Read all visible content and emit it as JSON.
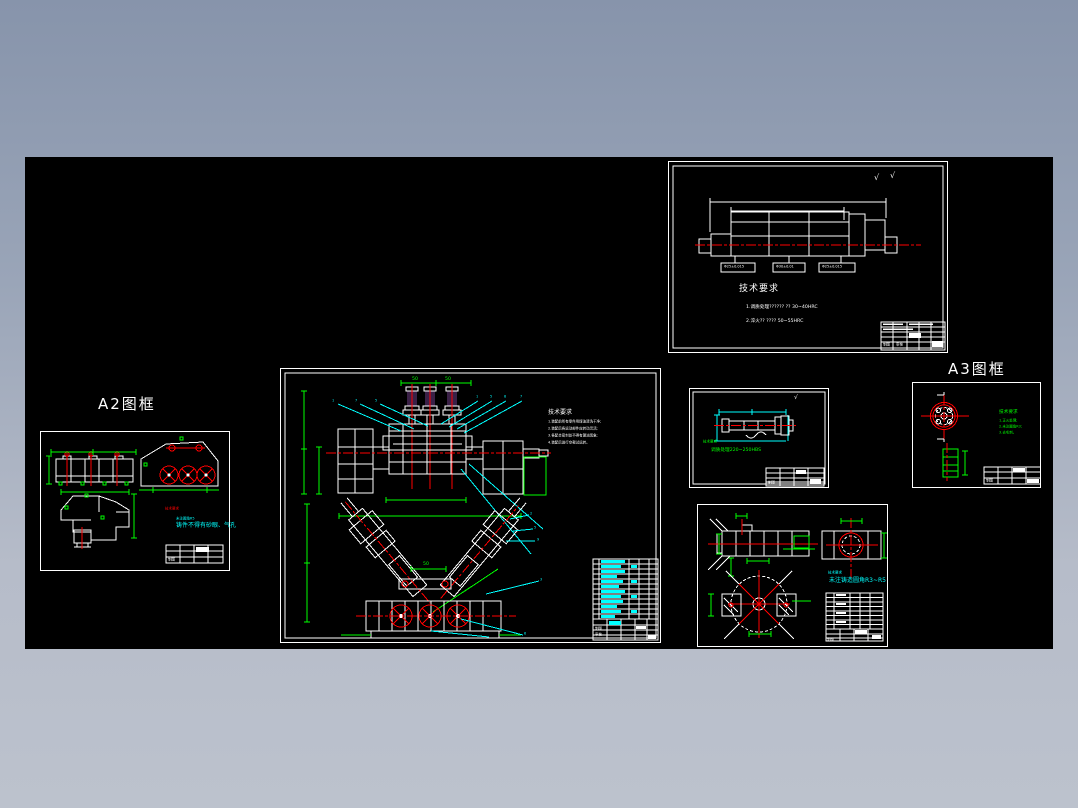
{
  "labels": {
    "a2_frame": "A2图框",
    "a3_frame": "A3图框"
  },
  "palette": {
    "line": "#ffffff",
    "centerline": "#ff0000",
    "dimension": "#00ff00",
    "leader": "#00ffff",
    "cylinder_fill": "#3a2147",
    "workspace": "#000000"
  },
  "shaft_frame": {
    "tech_title": "技术要求",
    "note1": "1.调质处理?????? ?? 30~40HRC",
    "note2": "2.淬火?? ???? 50~55HRC",
    "dim_box1": "Φ25±0.015",
    "dim_box2": "Φ30±0.01",
    "dim_box3": "Φ25±0.015",
    "roughness1": "√",
    "roughness2": "√"
  },
  "main_frame": {
    "dim_top_left": "50",
    "dim_top_right": "50",
    "dim_bottom": "50",
    "tech_title": "技术要求",
    "notes": [
      "1.装配前所有零件用煤油清洗干净;",
      "2.装配后各运动部件应转动灵活;",
      "3.各配合密封处不得有漏油现象;",
      "4.装配后进行空载试运转。"
    ],
    "balloons": [
      "1",
      "7",
      "5",
      "1",
      "5",
      "8",
      "7",
      "2",
      "5",
      "9",
      "3",
      "6"
    ]
  },
  "mid_frame": {
    "tech_note1": "技术要求",
    "tech_note2": "调质处理220~250HBS",
    "roughness": "√"
  },
  "right_frame": {
    "tech_title": "技术要求",
    "notes": [
      "1.正火处理;",
      "2.未注圆角R3;",
      "3.去毛刺。"
    ]
  },
  "a2_frame": {
    "red_note": "技术要求",
    "cyan_note1": "未注圆角R5",
    "cyan_note2": "铸件不得有砂眼、气孔"
  },
  "bottom_frame": {
    "cyan_note1": "技术要求",
    "cyan_note2": "未注铸造圆角R3~R5"
  },
  "title_blocks": {
    "draw": "制图",
    "check": "审核",
    "scale": "比例",
    "material": "材料",
    "qty": "数量",
    "name": "装配图"
  }
}
